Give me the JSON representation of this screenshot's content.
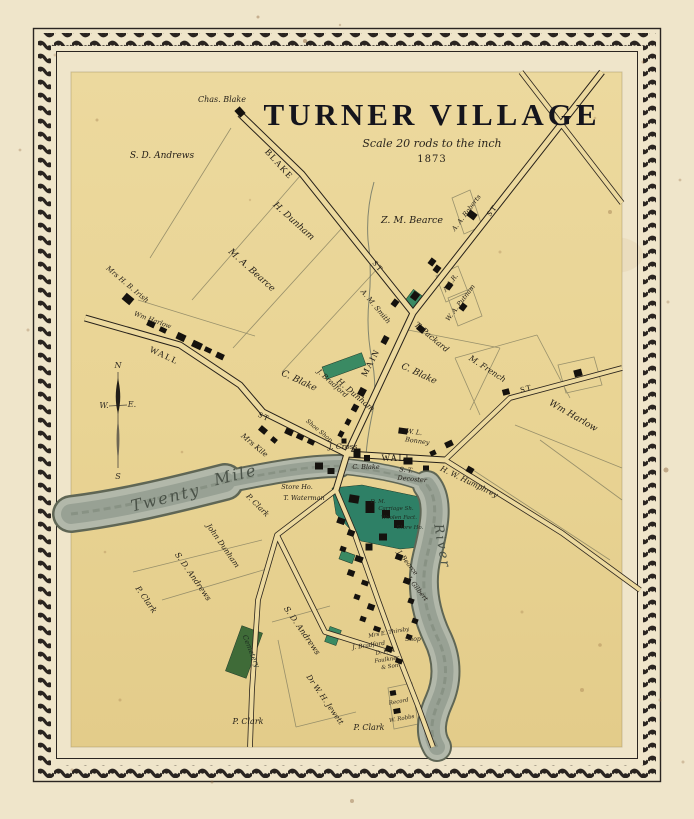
{
  "map": {
    "title": "TURNER VILLAGE",
    "scale_note": "Scale 20 rods to the inch",
    "year": "1873",
    "compass": {
      "north": "N",
      "south": "S",
      "east": "E.",
      "west": "W."
    },
    "colors": {
      "paper_outer": "#efe5ca",
      "paper_map": "#e9d494",
      "frame": "#2a2521",
      "road_fill": "#ecd99e",
      "ink": "#1e1a16",
      "river": "#b2b8aa",
      "river_edge": "#5f6655",
      "green_factory": "#2e8066",
      "green_light": "#3a8a63",
      "green_cemetery": "#3f6b38",
      "building": "#15120e",
      "lot_line": "#8f8866"
    },
    "labels": [
      {
        "t": "Chas. Blake",
        "x": 222,
        "y": 102,
        "r": 0,
        "s": 8,
        "c": "name"
      },
      {
        "t": "S. D. Andrews",
        "x": 162,
        "y": 158,
        "r": 0,
        "s": 9,
        "c": "name"
      },
      {
        "t": "BLAKE",
        "x": 277,
        "y": 166,
        "r": 48,
        "s": 9,
        "c": "street"
      },
      {
        "t": "ST",
        "x": 494,
        "y": 212,
        "r": -53,
        "s": 8,
        "c": "street"
      },
      {
        "t": "ST",
        "x": 376,
        "y": 268,
        "r": 50,
        "s": 8,
        "c": "street"
      },
      {
        "t": "MAIN",
        "x": 373,
        "y": 364,
        "r": -62,
        "s": 9,
        "c": "street"
      },
      {
        "t": "WALL",
        "x": 163,
        "y": 358,
        "r": 25,
        "s": 9,
        "c": "street"
      },
      {
        "t": "ST",
        "x": 263,
        "y": 419,
        "r": 25,
        "s": 8,
        "c": "street"
      },
      {
        "t": "WALL",
        "x": 397,
        "y": 461,
        "r": 0,
        "s": 9,
        "c": "street"
      },
      {
        "t": "ST",
        "x": 527,
        "y": 391,
        "r": -15,
        "s": 8,
        "c": "street"
      },
      {
        "t": "H. Dunham",
        "x": 292,
        "y": 223,
        "r": 42,
        "s": 9,
        "c": "name"
      },
      {
        "t": "M. A. Bearce",
        "x": 250,
        "y": 272,
        "r": 42,
        "s": 9,
        "c": "name"
      },
      {
        "t": "Mrs H. B. Irish",
        "x": 126,
        "y": 286,
        "r": 40,
        "s": 7,
        "c": "name"
      },
      {
        "t": "Z. M. Bearce",
        "x": 412,
        "y": 223,
        "r": 0,
        "s": 9.5,
        "c": "name"
      },
      {
        "t": "A. A. Roberts",
        "x": 468,
        "y": 214,
        "r": -53,
        "s": 6.5,
        "c": "name"
      },
      {
        "t": "A. M. Smith",
        "x": 374,
        "y": 308,
        "r": 50,
        "s": 7,
        "c": "name"
      },
      {
        "t": "A.A.R.",
        "x": 452,
        "y": 284,
        "r": -53,
        "s": 6.5,
        "c": "name"
      },
      {
        "t": "W. A. Putnam",
        "x": 462,
        "y": 304,
        "r": -53,
        "s": 6.5,
        "c": "name"
      },
      {
        "t": "T. Packard",
        "x": 430,
        "y": 339,
        "r": 40,
        "s": 8,
        "c": "name"
      },
      {
        "t": "C. Blake",
        "x": 418,
        "y": 376,
        "r": 25,
        "s": 9,
        "c": "name"
      },
      {
        "t": "M. French",
        "x": 486,
        "y": 371,
        "r": 33,
        "s": 8,
        "c": "name"
      },
      {
        "t": "Wm Harlow",
        "x": 572,
        "y": 418,
        "r": 30,
        "s": 9,
        "c": "name"
      },
      {
        "t": "C. Blake",
        "x": 298,
        "y": 383,
        "r": 25,
        "s": 9,
        "c": "name"
      },
      {
        "t": "H. Dunham",
        "x": 354,
        "y": 397,
        "r": 40,
        "s": 8,
        "c": "name"
      },
      {
        "t": "Wm Harlow",
        "x": 152,
        "y": 322,
        "r": 20,
        "s": 6.5,
        "c": "name"
      },
      {
        "t": "Mrs Kile",
        "x": 253,
        "y": 447,
        "r": 40,
        "s": 7.5,
        "c": "name"
      },
      {
        "t": "S. T.",
        "x": 406,
        "y": 472,
        "r": 5,
        "s": 6.5,
        "c": "name"
      },
      {
        "t": "Decoster",
        "x": 412,
        "y": 481,
        "r": 5,
        "s": 6.5,
        "c": "name"
      },
      {
        "t": "H. W. Humphrey",
        "x": 468,
        "y": 484,
        "r": 26,
        "s": 7.5,
        "c": "name"
      },
      {
        "t": "W. L.",
        "x": 414,
        "y": 434,
        "r": 8,
        "s": 6.5,
        "c": "name"
      },
      {
        "t": "Bonney",
        "x": 417,
        "y": 443,
        "r": 8,
        "s": 6.5,
        "c": "name"
      },
      {
        "t": "J. Cross",
        "x": 343,
        "y": 449,
        "r": 0,
        "s": 7.5,
        "c": "name"
      },
      {
        "t": "Shoe Shop",
        "x": 318,
        "y": 432,
        "r": 40,
        "s": 6,
        "c": "name"
      },
      {
        "t": "C. Blake",
        "x": 366,
        "y": 469,
        "r": 0,
        "s": 6.5,
        "c": "name"
      },
      {
        "t": "Store Ho.",
        "x": 297,
        "y": 489,
        "r": 0,
        "s": 6.5,
        "c": "name"
      },
      {
        "t": "T. Waterman",
        "x": 304,
        "y": 500,
        "r": 0,
        "s": 6.5,
        "c": "name"
      },
      {
        "t": "P. Clark",
        "x": 256,
        "y": 507,
        "r": 45,
        "s": 7.5,
        "c": "name"
      },
      {
        "t": "John Dunham",
        "x": 221,
        "y": 547,
        "r": 55,
        "s": 7.5,
        "c": "name"
      },
      {
        "t": "S. D. Andrews",
        "x": 191,
        "y": 578,
        "r": 55,
        "s": 8,
        "c": "name"
      },
      {
        "t": "P. Clark",
        "x": 144,
        "y": 601,
        "r": 55,
        "s": 8,
        "c": "name"
      },
      {
        "t": "S. D. Andrews",
        "x": 300,
        "y": 632,
        "r": 55,
        "s": 8,
        "c": "name"
      },
      {
        "t": "J. Bradford",
        "x": 331,
        "y": 385,
        "r": 42,
        "s": 7,
        "c": "name"
      },
      {
        "t": "J. Bearce",
        "x": 406,
        "y": 564,
        "r": 52,
        "s": 6.5,
        "c": "name"
      },
      {
        "t": "J. Gilbert",
        "x": 416,
        "y": 590,
        "r": 52,
        "s": 6.5,
        "c": "name"
      },
      {
        "t": "Shop",
        "x": 413,
        "y": 641,
        "r": 0,
        "s": 6,
        "c": "name"
      },
      {
        "t": "Mrs E. Thirsby",
        "x": 389,
        "y": 634,
        "r": -10,
        "s": 5.5,
        "c": "name"
      },
      {
        "t": "J. Bradford",
        "x": 369,
        "y": 647,
        "r": -8,
        "s": 6,
        "c": "name"
      },
      {
        "t": "D. F.",
        "x": 382,
        "y": 654,
        "r": -8,
        "s": 5.5,
        "c": "name"
      },
      {
        "t": "Faulkner",
        "x": 387,
        "y": 661,
        "r": -8,
        "s": 5.5,
        "c": "name"
      },
      {
        "t": "& Son",
        "x": 390,
        "y": 668,
        "r": -8,
        "s": 5.5,
        "c": "name"
      },
      {
        "t": "Dr W. H. Jewett",
        "x": 323,
        "y": 701,
        "r": 55,
        "s": 7.5,
        "c": "name"
      },
      {
        "t": "P. Clark",
        "x": 248,
        "y": 724,
        "r": 0,
        "s": 8,
        "c": "name"
      },
      {
        "t": "P. Clark",
        "x": 369,
        "y": 730,
        "r": 0,
        "s": 8,
        "c": "name"
      },
      {
        "t": "Record",
        "x": 399,
        "y": 703,
        "r": -10,
        "s": 5.5,
        "c": "name"
      },
      {
        "t": "W. Robbs",
        "x": 402,
        "y": 720,
        "r": -10,
        "s": 5.5,
        "c": "name"
      },
      {
        "t": "D. M.",
        "x": 378,
        "y": 503,
        "r": 0,
        "s": 5.5,
        "c": "landmark"
      },
      {
        "t": "Carriage Sh.",
        "x": 396,
        "y": 510,
        "r": 0,
        "s": 5.5,
        "c": "landmark"
      },
      {
        "t": "Woolen Fact.",
        "x": 399,
        "y": 519,
        "r": 0,
        "s": 5.5,
        "c": "landmark"
      },
      {
        "t": "Store Ho.",
        "x": 410,
        "y": 529,
        "r": 0,
        "s": 5.5,
        "c": "landmark"
      },
      {
        "t": "Cemetery",
        "x": 249,
        "y": 652,
        "r": 68,
        "s": 7,
        "c": "landmark"
      },
      {
        "t": "Twenty",
        "x": 167,
        "y": 503,
        "r": -14,
        "s": 16,
        "c": "river"
      },
      {
        "t": "Mile",
        "x": 237,
        "y": 480,
        "r": -14,
        "s": 16,
        "c": "river"
      },
      {
        "t": "River",
        "x": 438,
        "y": 547,
        "r": 80,
        "s": 13,
        "c": "river"
      }
    ],
    "buildings": [
      [
        240,
        112,
        9,
        7,
        48
      ],
      [
        128,
        299,
        10,
        8,
        40
      ],
      [
        151,
        324,
        8,
        6,
        25
      ],
      [
        163,
        330,
        7,
        5,
        25
      ],
      [
        181,
        337,
        9,
        7,
        25
      ],
      [
        197,
        345,
        10,
        7,
        25
      ],
      [
        208,
        350,
        7,
        5,
        25
      ],
      [
        220,
        356,
        8,
        6,
        25
      ],
      [
        472,
        215,
        7,
        9,
        -53
      ],
      [
        449,
        286,
        7,
        6,
        -53
      ],
      [
        463,
        307,
        7,
        6,
        -53
      ],
      [
        421,
        329,
        8,
        6,
        40
      ],
      [
        437,
        269,
        7,
        6,
        -53
      ],
      [
        415,
        296,
        8,
        7,
        -53
      ],
      [
        395,
        303,
        7,
        6,
        -53
      ],
      [
        385,
        340,
        8,
        6,
        -62
      ],
      [
        362,
        392,
        8,
        7,
        -62
      ],
      [
        355,
        408,
        7,
        6,
        -62
      ],
      [
        348,
        422,
        6,
        5,
        -62
      ],
      [
        341,
        434,
        6,
        5,
        -62
      ],
      [
        432,
        262,
        7,
        6,
        -53
      ],
      [
        289,
        432,
        8,
        6,
        25
      ],
      [
        300,
        437,
        7,
        5,
        25
      ],
      [
        311,
        442,
        7,
        5,
        25
      ],
      [
        263,
        430,
        8,
        6,
        40
      ],
      [
        274,
        440,
        6,
        5,
        40
      ],
      [
        319,
        466,
        8,
        7,
        0
      ],
      [
        331,
        471,
        7,
        6,
        0
      ],
      [
        357,
        453,
        7,
        9,
        0
      ],
      [
        367,
        458,
        6,
        6,
        0
      ],
      [
        344,
        441,
        5,
        5,
        0
      ],
      [
        403,
        431,
        9,
        6,
        8
      ],
      [
        449,
        444,
        8,
        6,
        -25
      ],
      [
        433,
        453,
        6,
        5,
        -25
      ],
      [
        408,
        461,
        9,
        7,
        0
      ],
      [
        426,
        468,
        6,
        5,
        0
      ],
      [
        470,
        470,
        7,
        6,
        30
      ],
      [
        506,
        392,
        7,
        6,
        -15
      ],
      [
        578,
        373,
        8,
        7,
        -15
      ],
      [
        354,
        499,
        10,
        8,
        10
      ],
      [
        370,
        507,
        9,
        12,
        0
      ],
      [
        386,
        514,
        8,
        8,
        0
      ],
      [
        399,
        524,
        10,
        8,
        0
      ],
      [
        383,
        537,
        8,
        7,
        0
      ],
      [
        369,
        547,
        7,
        7,
        0
      ],
      [
        341,
        521,
        8,
        6,
        20
      ],
      [
        351,
        533,
        7,
        6,
        20
      ],
      [
        343,
        549,
        6,
        5,
        20
      ],
      [
        359,
        559,
        8,
        6,
        20
      ],
      [
        351,
        573,
        7,
        6,
        20
      ],
      [
        365,
        583,
        7,
        5,
        20
      ],
      [
        357,
        597,
        6,
        5,
        20
      ],
      [
        371,
        607,
        7,
        6,
        20
      ],
      [
        363,
        619,
        6,
        5,
        20
      ],
      [
        377,
        629,
        7,
        5,
        20
      ],
      [
        389,
        649,
        7,
        6,
        20
      ],
      [
        399,
        661,
        7,
        5,
        20
      ],
      [
        399,
        557,
        7,
        6,
        20
      ],
      [
        407,
        581,
        7,
        6,
        20
      ],
      [
        411,
        601,
        6,
        5,
        20
      ],
      [
        415,
        621,
        6,
        5,
        20
      ],
      [
        409,
        637,
        6,
        5,
        20
      ],
      [
        393,
        693,
        6,
        5,
        -10
      ],
      [
        397,
        711,
        7,
        5,
        -10
      ]
    ],
    "greens": [
      {
        "shape": "rect",
        "cx": 344,
        "cy": 366,
        "w": 42,
        "h": 13,
        "r": -20,
        "k": "light"
      },
      {
        "shape": "rect",
        "cx": 413,
        "cy": 299,
        "w": 16,
        "h": 11,
        "r": -53,
        "k": "light"
      },
      {
        "shape": "poly",
        "pts": "332,488 362,485 420,497 437,509 431,546 400,549 361,541 336,514",
        "k": "factory"
      },
      {
        "shape": "rect",
        "cx": 347,
        "cy": 557,
        "w": 14,
        "h": 9,
        "r": 20,
        "k": "light"
      },
      {
        "shape": "rect",
        "cx": 333,
        "cy": 636,
        "w": 12,
        "h": 16,
        "r": 20,
        "k": "light"
      },
      {
        "shape": "rect",
        "cx": 244,
        "cy": 652,
        "w": 22,
        "h": 48,
        "r": 20,
        "k": "cemetery"
      }
    ]
  }
}
